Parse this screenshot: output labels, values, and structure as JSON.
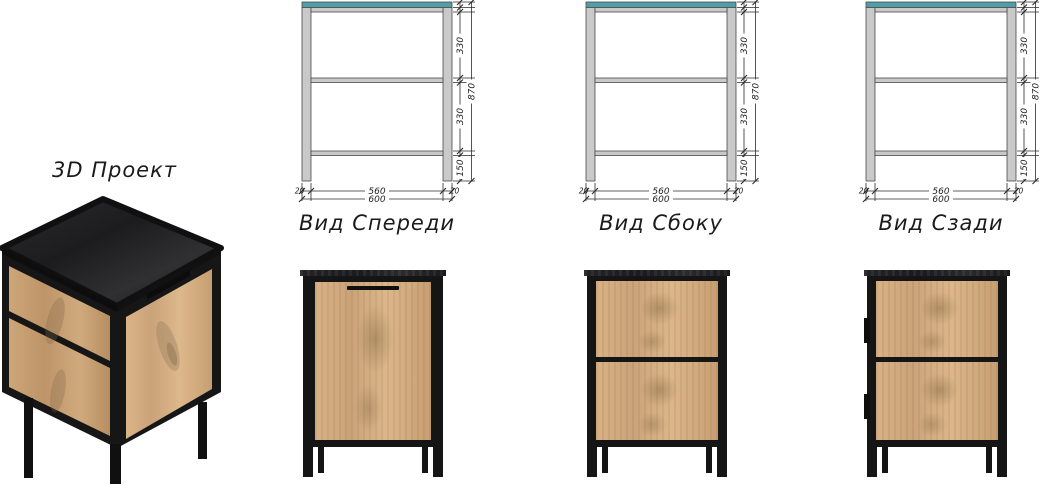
{
  "sheet": {
    "title": "3D Проект"
  },
  "views": [
    {
      "id": "front",
      "label": "Вид Спереди"
    },
    {
      "id": "side",
      "label": "Вид Сбоку"
    },
    {
      "id": "rear",
      "label": "Вид Сзади"
    }
  ],
  "drawing_dims": {
    "top_section": "330",
    "bottom_section": "330",
    "leg_height": "150",
    "total_height": "870",
    "left_leg_width": "20",
    "inner_width": "560",
    "right_leg_width": "20",
    "total_width": "600"
  },
  "colors": {
    "teal": "#4F9EA8",
    "frame_gray": "#C9C9C9",
    "frame_stroke": "#4A4A4A",
    "dim_line": "#2B2B2B",
    "text": "#1E1E1E",
    "metal": "#151515",
    "wood": "#D2AB7F",
    "slab": "#222220"
  }
}
